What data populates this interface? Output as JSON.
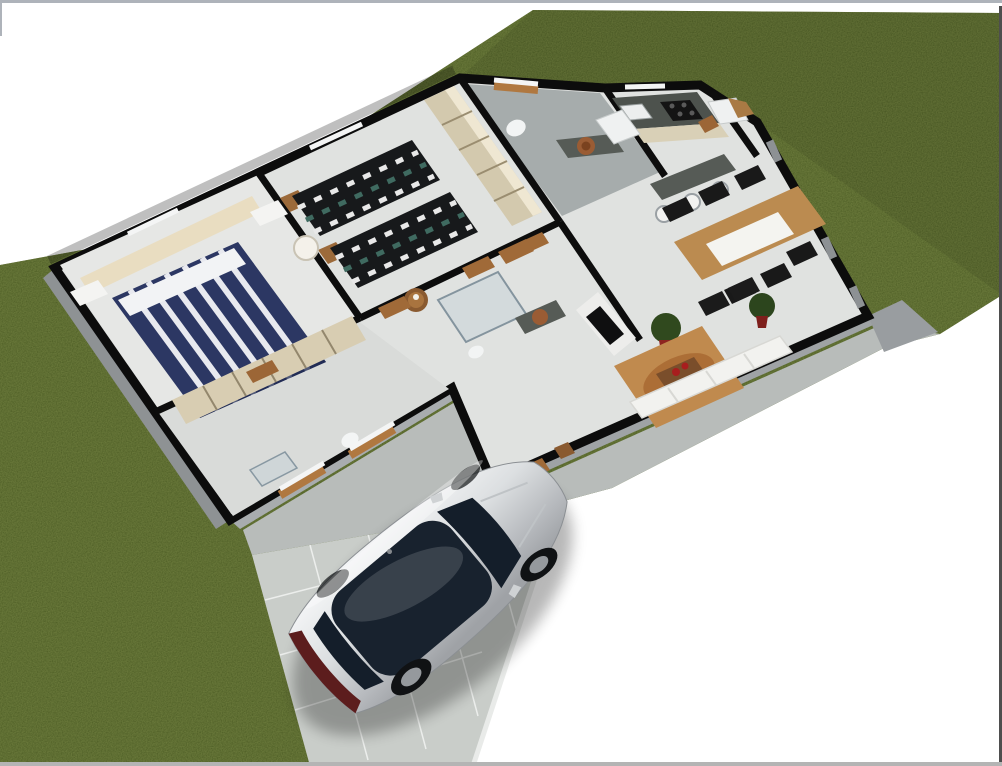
{
  "meta": {
    "title": "3D aerial floor plan render of a single-storey house",
    "view": "three-quarter aerial cutaway (no roof)",
    "canvas": {
      "width": 1002,
      "height": 766
    }
  },
  "palette": {
    "background": "#ffffff",
    "border_light": "#aeb3ba",
    "border_bottom": "#b4b4b4",
    "border_dark": "#4e4e4e",
    "grass": "#4a5420",
    "backyard_shade": "#00000014",
    "concrete": "#b8bcba",
    "driveway": "#c9cdc9",
    "curb": "#e9ebe9",
    "floor": "#e0e2e0",
    "floor_bright": "#e6e7e5",
    "floor_front": "#d9dbd9",
    "bath_tile": "#a6acac",
    "wall_top": "#0c0c0c",
    "wall_face_light": "#a8acae",
    "wall_face_mid": "#9fa3a5",
    "wall_face_dark": "#8e9294",
    "wood": "#a06a38",
    "wood_dark": "#7a4e2b",
    "wood_table": "#bb8b50",
    "beige": "#e9ddc1",
    "closet_beige": "#d8cdb2",
    "wardrobe_tan": "#d3c9ae",
    "bed_navy": "#2c3763",
    "bed_stripe": "#e8e9ef",
    "bed_dark": "#17191b",
    "checker_teal": "#3f6a60",
    "granite": "#4d524d",
    "granite_bar": "#565b56",
    "cabinet_beige": "#d9d0b7",
    "white_goods": "#eff1f1",
    "rug": "#c08a4e",
    "rug_dark": "#a4622c",
    "sofa": "#f2f2ef",
    "chair_black": "#191919",
    "plant_green": "#30491e",
    "pot_red": "#8e2520",
    "sink_copper": "#9a5c34",
    "car_silver_light": "#f5f6f7",
    "car_silver": "#c6c9cc",
    "car_silver_dark": "#aaadb1",
    "car_glass": "#18222e",
    "car_tail": "#5c1d1d",
    "wheel": "#101214",
    "rim": "#95999d"
  },
  "scene": {
    "lot": {
      "ground": "lawn grass",
      "texture": "noisy turf",
      "surroundings": "white page background at top-left and bottom-right corners"
    },
    "driveway": {
      "surface": "light concrete tiles",
      "position": "front of house, bottom-centre",
      "vehicle_parked": true
    },
    "vehicle": {
      "type": "silver coupe",
      "features": [
        "tinted glass roof",
        "dark windshield",
        "maroon tail-light band",
        "alloy wheels"
      ],
      "orientation": "nose pointing toward house entry"
    },
    "house": {
      "storeys": 1,
      "walls": "cutaway walls with black tops and grey faces",
      "rooms": [
        {
          "name": "master bedroom",
          "furniture": [
            "double bed with navy/white striped spread",
            "beige headboard panel",
            "two white nightstands",
            "open closet cubbies"
          ]
        },
        {
          "name": "second bedroom",
          "furniture": [
            "two single beds with dark checkered spreads",
            "wood headboards",
            "white cone lamp",
            "tan wardrobe with open shelves"
          ]
        },
        {
          "name": "bathroom (rear)",
          "furniture": [
            "granite vanity",
            "round copper basin",
            "toilet",
            "rear window"
          ]
        },
        {
          "name": "bathroom (central)",
          "furniture": [
            "glass shower",
            "granite vanity",
            "round copper basin",
            "toilet"
          ]
        },
        {
          "name": "hallway",
          "furniture": [
            "small round wood table"
          ]
        },
        {
          "name": "front room / ensuite",
          "furniture": [
            "toilet",
            "glass shower",
            "front windows with wood sills"
          ]
        },
        {
          "name": "kitchen",
          "furniture": [
            "granite counter",
            "4-burner cooktop",
            "steel sink",
            "beige cabinet fronts",
            "white fridge",
            "granite breakfast bar",
            "three white bar stools"
          ]
        },
        {
          "name": "laundry",
          "furniture": [
            "white washing machine",
            "wood counter",
            "wood door"
          ]
        },
        {
          "name": "dining area",
          "furniture": [
            "wood table with white runner",
            "six black chairs",
            "potted plants in red pots",
            "glass rear wall with posts"
          ]
        },
        {
          "name": "living room",
          "furniture": [
            "TV on white cabinet",
            "rust-tan area rug",
            "wood coffee table",
            "red vases",
            "white sofa",
            "two black armchairs",
            "wood entry door"
          ]
        }
      ]
    }
  }
}
